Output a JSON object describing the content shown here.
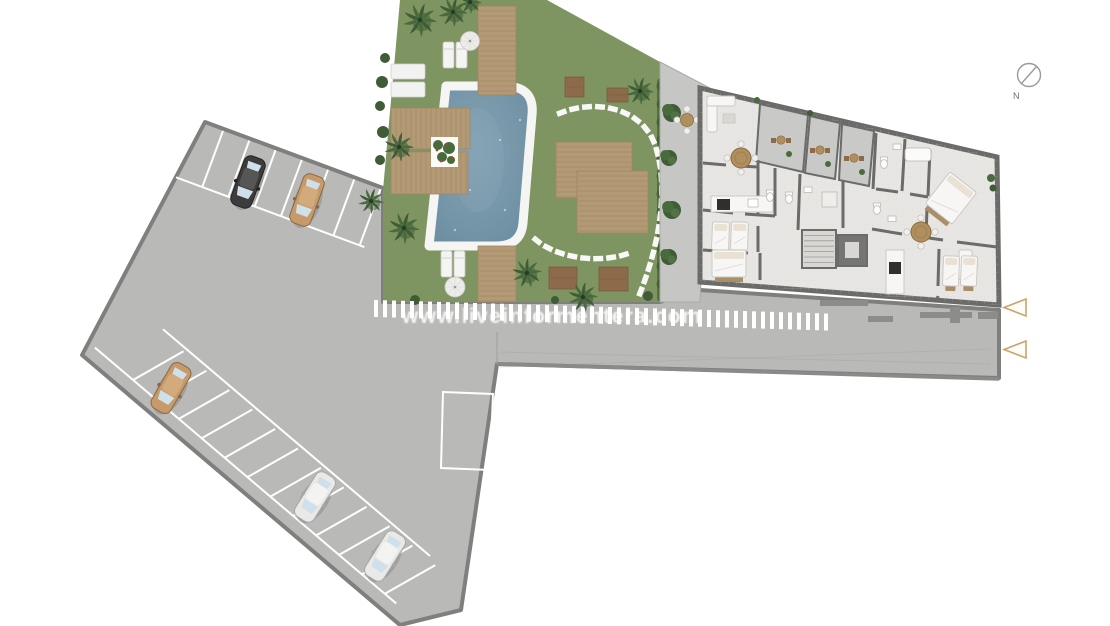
{
  "image_type": "architectural-site-plan",
  "compass": {
    "label": "N"
  },
  "watermark": {
    "text": "www.liveinformentera.com"
  },
  "palette": {
    "background": "#ffffff",
    "pavement": "#b9b9b7",
    "pavement_border": "#7f7f7d",
    "walkway": "#c6c6c4",
    "marking_white": "#ffffff",
    "curb": "#8a8a88",
    "garden_green": "#7e9562",
    "foliage_dark": "#3f5c37",
    "foliage_mid": "#486b3c",
    "foliage_light": "#5d7a4a",
    "hedge": "#55703f",
    "pool_water": "#6f90a4",
    "pool_water_light": "#84a3b4",
    "pool_coping": "#f5f5f3",
    "deck_wood": "#b39a75",
    "deck_line": "#9d8663",
    "mat_brown": "#8d6b4a",
    "building_floor": "#e7e6e3",
    "building_wall": "#6b6b69",
    "terrace_paving": "#c9c9c7",
    "furniture_wood": "#b08f5f",
    "fixture_white": "#f7f6f4",
    "fixture_stroke": "#c6c5c2",
    "stove_black": "#2f2f2d",
    "car_black": "#3c3c3c",
    "car_black_roof": "#565654",
    "car_tan": "#c79a6a",
    "car_tan_roof": "#d2aa7c",
    "car_white": "#e9e9e7",
    "car_white_roof": "#f3f3f1",
    "car_glass": "#cfe0ea",
    "accent_tan": "#c9a56b",
    "compass_gray": "#9a9a98"
  },
  "site": {
    "parking": {
      "car_count": 5,
      "cars": [
        {
          "name": "black-car",
          "row": "top",
          "color_key": "car_black"
        },
        {
          "name": "tan-car",
          "row": "top",
          "color_key": "car_tan"
        },
        {
          "name": "tan-car",
          "row": "side",
          "color_key": "car_tan"
        },
        {
          "name": "white-car",
          "row": "side",
          "color_key": "car_white"
        },
        {
          "name": "white-car",
          "row": "side",
          "color_key": "car_white"
        }
      ],
      "top_bay_count": 7,
      "side_bay_count": 12,
      "reserved_bay_count": 1
    },
    "garden": {
      "pool_count": 1,
      "palm_count": 9,
      "deck_count": 6,
      "sun_lounger_count": 6,
      "umbrella_count": 2,
      "stepping_stone_paths": 2,
      "planter_count": 1
    },
    "walkway": {
      "tree_count": 4,
      "outdoor_table_count": 1
    },
    "building": {
      "apartment_unit_count": 2,
      "terrace_count": 3,
      "dining_table_count": 2,
      "bed_count": 5,
      "kitchen_count": 2,
      "elevator_count": 1
    },
    "entrance_arrow_count": 2
  }
}
